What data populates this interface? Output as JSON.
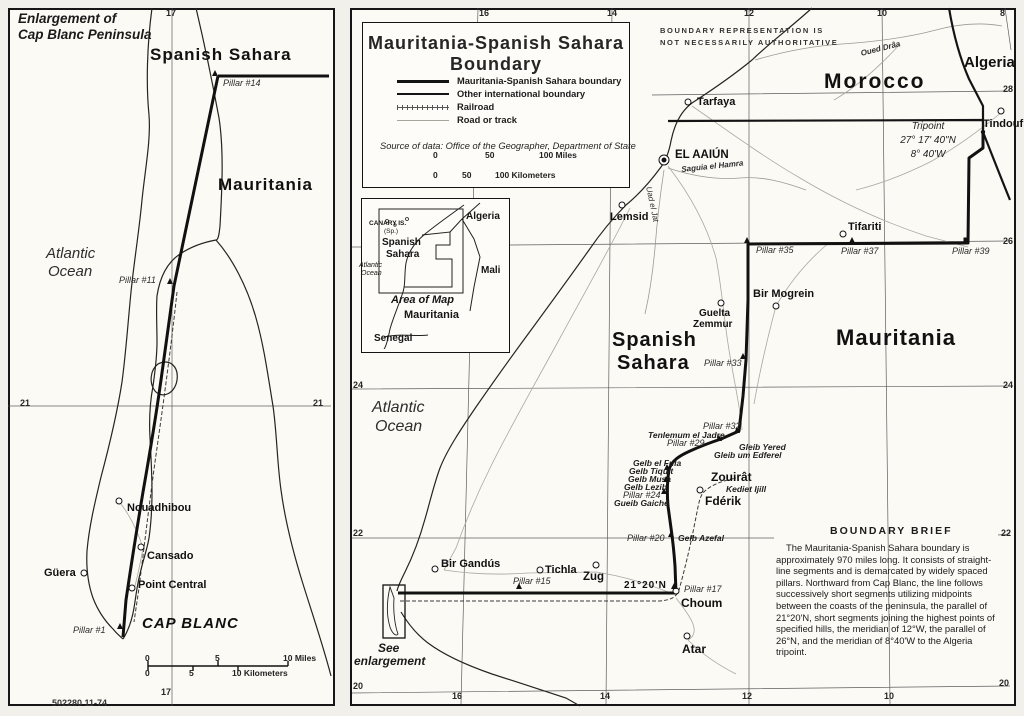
{
  "colors": {
    "ink": "#1b1b1b",
    "road": "#a7a39b",
    "paper": "#f6f4ee"
  },
  "footer": {
    "id": "502280 11-74",
    "watermark": "Digitized b"
  },
  "left_panel": {
    "title1": "Enlargement of",
    "title2": "Cap Blanc Peninsula",
    "grid_labels": [
      {
        "t": "17",
        "x": 166,
        "y": 9
      },
      {
        "t": "17",
        "x": 161,
        "y": 688
      },
      {
        "t": "21",
        "x": 20,
        "y": 399
      },
      {
        "t": "21",
        "x": 313,
        "y": 399
      }
    ],
    "region_labels": [
      {
        "t": "Spanish Sahara",
        "x": 150,
        "y": 46,
        "s": 17,
        "c": "ls1"
      },
      {
        "t": "Mauritania",
        "x": 218,
        "y": 176,
        "s": 17,
        "c": "ls1"
      },
      {
        "t": "CAP BLANC",
        "x": 142,
        "y": 616,
        "s": 15,
        "i": 1,
        "c": "ls1"
      }
    ],
    "water_labels": [
      {
        "t": "Atlantic",
        "x": 46,
        "y": 246,
        "s": 15
      },
      {
        "t": "Ocean",
        "x": 48,
        "y": 264,
        "s": 15
      }
    ],
    "towns": [
      {
        "t": "Nouadhibou",
        "x": 127,
        "y": 503,
        "mx": 119,
        "my": 501
      },
      {
        "t": "Cansado",
        "x": 147,
        "y": 551,
        "mx": 141,
        "my": 547
      },
      {
        "t": "Güera",
        "x": 44,
        "y": 568,
        "mx": 84,
        "my": 573
      },
      {
        "t": "Point Central",
        "x": 138,
        "y": 580,
        "mx": 132,
        "my": 588
      }
    ],
    "pillars": [
      {
        "t": "Pillar #14",
        "x": 223,
        "y": 79,
        "mx": 215,
        "my": 73,
        "ms": "m-tri"
      },
      {
        "t": "Pillar #11",
        "x": 119,
        "y": 276,
        "mx": 170,
        "my": 281,
        "ms": "m-tri"
      },
      {
        "t": "Pillar #1",
        "x": 73,
        "y": 626,
        "mx": 120,
        "my": 626,
        "ms": "m-tri"
      }
    ],
    "scale_labels": [
      {
        "t": "0",
        "x": 145,
        "y": 654
      },
      {
        "t": "5",
        "x": 215,
        "y": 654
      },
      {
        "t": "10 Miles",
        "x": 283,
        "y": 654
      },
      {
        "t": "0",
        "x": 145,
        "y": 669
      },
      {
        "t": "5",
        "x": 189,
        "y": 669
      },
      {
        "t": "10 Kilometers",
        "x": 232,
        "y": 669
      }
    ]
  },
  "right_panel": {
    "disclaimer1": "BOUNDARY REPRESENTATION IS",
    "disclaimer2": "NOT NECESSARILY AUTHORITATIVE",
    "box": {
      "title1": "Mauritania-Spanish Sahara",
      "title2": "Boundary",
      "legend": [
        {
          "t": "Mauritania-Spanish Sahara boundary",
          "sw": "sw-b1"
        },
        {
          "t": "Other international boundary",
          "sw": "sw-b2"
        },
        {
          "t": "Railroad",
          "sw": "sw-rail"
        },
        {
          "t": "Road or track",
          "sw": "sw-road"
        }
      ],
      "source": "Source of data: Office of the Geographer, Department of State"
    },
    "scale_labels": [
      {
        "t": "0",
        "x": 433,
        "y": 151
      },
      {
        "t": "50",
        "x": 485,
        "y": 151
      },
      {
        "t": "100 Miles",
        "x": 539,
        "y": 151
      },
      {
        "t": "0",
        "x": 433,
        "y": 171
      },
      {
        "t": "50",
        "x": 462,
        "y": 171
      },
      {
        "t": "100 Kilometers",
        "x": 495,
        "y": 171
      }
    ],
    "grid_labels": [
      {
        "t": "16",
        "x": 479,
        "y": 9
      },
      {
        "t": "14",
        "x": 607,
        "y": 9
      },
      {
        "t": "12",
        "x": 744,
        "y": 9
      },
      {
        "t": "10",
        "x": 877,
        "y": 9
      },
      {
        "t": "8",
        "x": 1000,
        "y": 9
      },
      {
        "t": "16",
        "x": 452,
        "y": 692
      },
      {
        "t": "14",
        "x": 600,
        "y": 692
      },
      {
        "t": "12",
        "x": 742,
        "y": 692
      },
      {
        "t": "10",
        "x": 884,
        "y": 692
      },
      {
        "t": "28",
        "x": 1003,
        "y": 85
      },
      {
        "t": "26",
        "x": 1003,
        "y": 237
      },
      {
        "t": "24",
        "x": 1003,
        "y": 381
      },
      {
        "t": "22",
        "x": 1001,
        "y": 529
      },
      {
        "t": "20",
        "x": 999,
        "y": 679
      },
      {
        "t": "24",
        "x": 353,
        "y": 381
      },
      {
        "t": "22",
        "x": 353,
        "y": 529
      },
      {
        "t": "20",
        "x": 353,
        "y": 682
      }
    ],
    "region_labels": [
      {
        "t": "Morocco",
        "x": 824,
        "y": 71,
        "s": 21,
        "c": "ls2"
      },
      {
        "t": "Algeria",
        "x": 964,
        "y": 55,
        "s": 15
      },
      {
        "t": "Mauritania",
        "x": 836,
        "y": 327,
        "s": 22,
        "c": "ls1"
      },
      {
        "t": "Spanish",
        "x": 612,
        "y": 330,
        "s": 20,
        "c": "ls1"
      },
      {
        "t": "Sahara",
        "x": 617,
        "y": 353,
        "s": 20,
        "c": "ls1"
      }
    ],
    "water_labels": [
      {
        "t": "Atlantic",
        "x": 372,
        "y": 400,
        "s": 16
      },
      {
        "t": "Ocean",
        "x": 375,
        "y": 419,
        "s": 16
      },
      {
        "t": "Saguia el Hamra",
        "x": 681,
        "y": 166,
        "s": 8,
        "r": -6,
        "b": 1
      },
      {
        "t": "Oued Drâa",
        "x": 860,
        "y": 50,
        "s": 8,
        "r": -14,
        "b": 1
      },
      {
        "t": "Uad el Jat",
        "x": 652,
        "y": 186,
        "s": 8,
        "r": 78
      }
    ],
    "towns": [
      {
        "t": "Tarfaya",
        "x": 697,
        "y": 97,
        "mx": 688,
        "my": 102
      },
      {
        "t": "EL AAIÚN",
        "x": 675,
        "y": 150,
        "s": 11.5,
        "mx": 664,
        "my": 160,
        "ms": "m-circle2"
      },
      {
        "t": "Lemsid",
        "x": 610,
        "y": 212,
        "mx": 622,
        "my": 205
      },
      {
        "t": "Tifariti",
        "x": 848,
        "y": 222,
        "mx": 843,
        "my": 234
      },
      {
        "t": "Tindouf",
        "x": 983,
        "y": 119,
        "mx": 1001,
        "my": 111
      },
      {
        "t": "Bir Mogrein",
        "x": 753,
        "y": 289,
        "mx": 776,
        "my": 306
      },
      {
        "t": "Guelta",
        "x": 699,
        "y": 309,
        "s": 10
      },
      {
        "t": "Zemmur",
        "x": 693,
        "y": 320,
        "s": 10,
        "mx": 721,
        "my": 303
      },
      {
        "t": "Zouirât",
        "x": 711,
        "y": 471,
        "s": 12
      },
      {
        "t": "Fdérik",
        "x": 705,
        "y": 495,
        "s": 12,
        "mx": 700,
        "my": 490
      },
      {
        "t": "Choum",
        "x": 681,
        "y": 597,
        "s": 12,
        "mx": 676,
        "my": 591
      },
      {
        "t": "Atar",
        "x": 682,
        "y": 643,
        "s": 12,
        "mx": 687,
        "my": 636
      },
      {
        "t": "Bir Gandús",
        "x": 441,
        "y": 559,
        "mx": 435,
        "my": 569
      },
      {
        "t": "Tichla",
        "x": 545,
        "y": 565,
        "mx": 540,
        "my": 570
      },
      {
        "t": "Zug",
        "x": 583,
        "y": 572,
        "s": 11.5,
        "mx": 596,
        "my": 565
      },
      {
        "t": "21°20'N",
        "x": 624,
        "y": 581,
        "s": 10,
        "c": "ls1"
      }
    ],
    "pillars": [
      {
        "t": "Pillar #35",
        "x": 756,
        "y": 246,
        "mx": 747,
        "my": 240,
        "ms": "m-tri"
      },
      {
        "t": "Pillar #37",
        "x": 841,
        "y": 247,
        "mx": 852,
        "my": 240,
        "ms": "m-tri"
      },
      {
        "t": "Pillar #39",
        "x": 952,
        "y": 247,
        "mx": 966,
        "my": 240,
        "ms": "m-sq"
      },
      {
        "t": "Pillar #33",
        "x": 704,
        "y": 359,
        "mx": 743,
        "my": 356,
        "ms": "m-tri"
      },
      {
        "t": "Pillar #32",
        "x": 703,
        "y": 422,
        "mx": 737,
        "my": 430,
        "ms": "m-tri"
      },
      {
        "t": "Pillar #29",
        "x": 667,
        "y": 439,
        "mx": 719,
        "my": 438,
        "ms": "m-tri"
      },
      {
        "t": "Pillar #24",
        "x": 623,
        "y": 491,
        "mx": 664,
        "my": 491,
        "ms": "m-tri"
      },
      {
        "t": "Pillar #20",
        "x": 627,
        "y": 534,
        "mx": 671,
        "my": 534,
        "ms": "m-tri"
      },
      {
        "t": "Pillar #17",
        "x": 684,
        "y": 585,
        "mx": 674,
        "my": 586,
        "ms": "m-tri"
      },
      {
        "t": "Pillar #15",
        "x": 513,
        "y": 577,
        "mx": 519,
        "my": 586,
        "ms": "m-tri"
      }
    ],
    "hills": [
      {
        "t": "Tenlemum el Jadre",
        "x": 648,
        "y": 431
      },
      {
        "t": "Gleib Yered",
        "x": 739,
        "y": 443
      },
      {
        "t": "Gleib um Edferel",
        "x": 714,
        "y": 451
      },
      {
        "t": "Gelb el Fula",
        "x": 633,
        "y": 459,
        "mx": 667,
        "my": 467,
        "ms": "m-tri"
      },
      {
        "t": "Gelb Tiquit",
        "x": 629,
        "y": 467
      },
      {
        "t": "Gelb Musa",
        "x": 628,
        "y": 475,
        "mx": 666,
        "my": 479,
        "ms": "m-tri"
      },
      {
        "t": "Gelb Lezib",
        "x": 624,
        "y": 483
      },
      {
        "t": "Gueib Gaiche",
        "x": 614,
        "y": 499
      },
      {
        "t": "Gelb Azefal",
        "x": 678,
        "y": 534
      },
      {
        "t": "Kediet Ijill",
        "x": 726,
        "y": 485
      }
    ],
    "tripoint": {
      "l1": "Tripoint",
      "l2": "27° 17' 40\"N",
      "l3": "8° 40'W"
    },
    "brief": {
      "heading": "BOUNDARY BRIEF",
      "body": "The Mauritania-Spanish Sahara boundary is approximately 970 miles long. It consists of straight-line segments and is demarcated by widely spaced pillars. Northward from Cap Blanc, the line follows successively short segments utilizing midpoints between the coasts of the peninsula, the parallel of 21°20'N, short segments joining the highest points of specified hills, the meridian of 12°W, the parallel of 26°N, and the meridian of 8°40'W to the Algeria tripoint."
    },
    "see1": "See",
    "see2": "enlargement",
    "inset_labels": [
      {
        "t": "CANARY IS.",
        "x": 369,
        "y": 221,
        "s": 6.5,
        "b": 1
      },
      {
        "t": "(Sp.)",
        "x": 384,
        "y": 229,
        "s": 6.5
      },
      {
        "t": "Spanish",
        "x": 382,
        "y": 238,
        "s": 10,
        "b": 1
      },
      {
        "t": "Sahara",
        "x": 386,
        "y": 250,
        "s": 10,
        "b": 1
      },
      {
        "t": "Atlantic",
        "x": 359,
        "y": 262,
        "s": 7,
        "i": 1
      },
      {
        "t": "Ocean",
        "x": 361,
        "y": 270,
        "s": 7,
        "i": 1
      },
      {
        "t": "Algeria",
        "x": 466,
        "y": 212,
        "s": 10,
        "b": 1
      },
      {
        "t": "Mali",
        "x": 481,
        "y": 266,
        "s": 10,
        "b": 1
      },
      {
        "t": "Area of Map",
        "x": 391,
        "y": 295,
        "s": 11,
        "i": 1,
        "b": 1
      },
      {
        "t": "Mauritania",
        "x": 404,
        "y": 310,
        "s": 11,
        "b": 1
      },
      {
        "t": "Senegal",
        "x": 374,
        "y": 334,
        "s": 10,
        "b": 1
      }
    ]
  }
}
